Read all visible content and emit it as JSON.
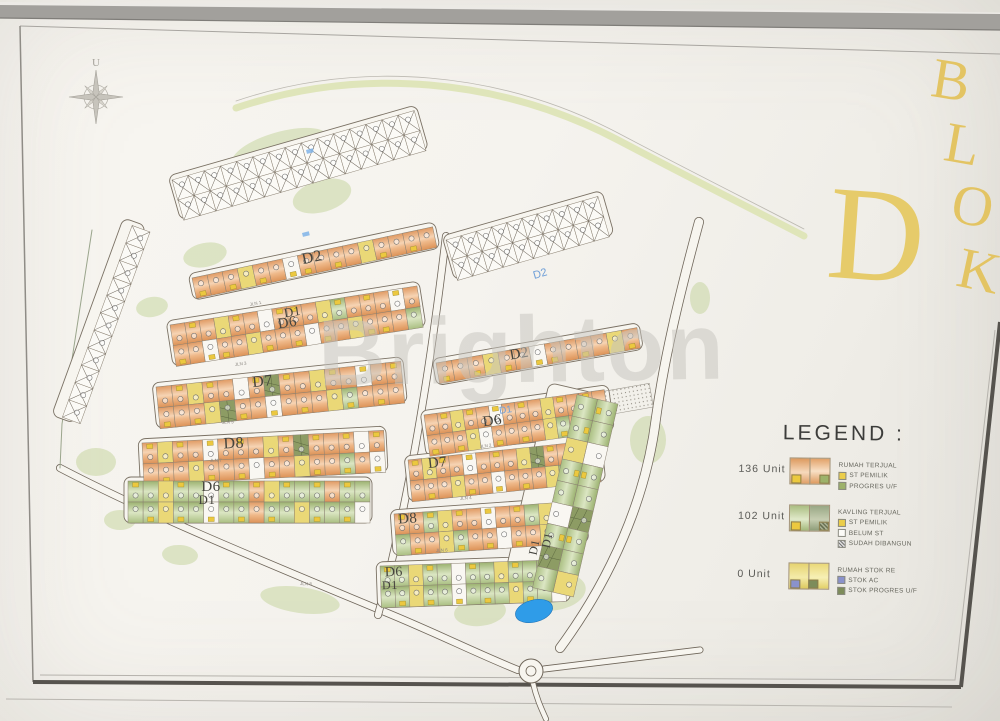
{
  "watermark": {
    "text": "Brighton"
  },
  "title": {
    "big_letter": "D",
    "vertical": [
      "B",
      "L",
      "O",
      "K"
    ],
    "color": "#e3c463"
  },
  "compass": {
    "label": "U"
  },
  "legend": {
    "title": "LEGEND :",
    "colors": {
      "yellow_mark": "#ecc93f",
      "green_mark": "#9db26a",
      "blue_mark": "#8a92cc",
      "dark_mark": "#7d8c5a"
    },
    "entries": [
      {
        "count": "136 Unit",
        "swatch": "orange",
        "lines": [
          {
            "text": "RUMAH TERJUAL"
          },
          {
            "box": "yellow",
            "text": "ST PEMILIK"
          },
          {
            "box": "green",
            "text": "PROGRES U/F"
          }
        ]
      },
      {
        "count": "102 Unit",
        "swatch": "green",
        "lines": [
          {
            "text": "KAVLING TERJUAL"
          },
          {
            "box": "yellow",
            "text": "ST PEMILIK"
          },
          {
            "box": "white",
            "text": "BELUM ST"
          },
          {
            "box": "hatch",
            "text": "SUDAH DIBANGUN"
          }
        ]
      },
      {
        "count": "0 Unit",
        "swatch": "yellow",
        "lines": [
          {
            "text": "RUMAH STOK RE"
          },
          {
            "box": "blue",
            "text": "STOK AC"
          },
          {
            "box": "dark",
            "text": "STOK PROGRES U/F"
          }
        ]
      }
    ]
  },
  "map": {
    "palette": {
      "orange": "#e8a567",
      "green": "#a9bd80",
      "yellow": "#ead877",
      "marker": "#ecc83f",
      "pond": "#2f9ce8",
      "road_line": "#6e6559",
      "paper": "#f7f5ef"
    },
    "strips": [
      {
        "x": 172,
        "y": 180,
        "a": -16,
        "len": 252,
        "w": 21,
        "m": "b",
        "lots": "xxxxxxxxxxxxxxx"
      },
      {
        "x": 178,
        "y": 200,
        "a": -16,
        "len": 252,
        "w": 21,
        "m": "b",
        "lots": "xxxxxxxxxxxxxxx"
      },
      {
        "x": 192,
        "y": 278,
        "a": -12,
        "len": 246,
        "w": 21,
        "m": "b",
        "lots": "OoOyOoWOoOoyOoOo"
      },
      {
        "x": 170,
        "y": 325,
        "a": -9,
        "len": 250,
        "w": 21,
        "m": "t",
        "lots": "oOoyOowOOoyGoOoWo"
      },
      {
        "x": 173,
        "y": 345.7,
        "a": -9,
        "len": 250,
        "w": 21,
        "m": "b",
        "lots": "OoWOoyOoOwOoyOOog"
      },
      {
        "x": 156,
        "y": 387,
        "a": -6,
        "len": 246,
        "w": 21,
        "m": "t",
        "lots": "oOyOowOdOoyOoWoO"
      },
      {
        "x": 158,
        "y": 407.9,
        "a": -6,
        "len": 246,
        "w": 21,
        "m": "b",
        "lots": "OoOydOoWoOoyGoOo"
      },
      {
        "x": 142,
        "y": 443,
        "a": -3,
        "len": 242,
        "w": 21,
        "m": "t",
        "lots": "OyOoWoOoyOdOoOwO"
      },
      {
        "x": 143,
        "y": 463.9,
        "a": -3,
        "len": 242,
        "w": 21,
        "m": "b",
        "lots": "oOoyOoOwOoyOoGoW"
      },
      {
        "x": 128,
        "y": 481,
        "a": 0,
        "len": 242,
        "w": 21,
        "m": "t",
        "lots": "GgyGgwGgOyGgGoGg"
      },
      {
        "x": 128,
        "y": 502,
        "a": 0,
        "len": 242,
        "w": 21,
        "m": "b",
        "lots": "gGyGgWgGoGgyGgGw"
      },
      {
        "x": 446,
        "y": 240,
        "a": -16,
        "len": 158,
        "w": 21,
        "m": "b",
        "lots": "xxxxxxxxxx"
      },
      {
        "x": 451.8,
        "y": 260.2,
        "a": -16,
        "len": 158,
        "w": 21,
        "m": "b",
        "lots": "xxxxxxxxxx"
      },
      {
        "x": 436,
        "y": 363,
        "a": -10,
        "len": 204,
        "w": 21,
        "m": "b",
        "lots": "OoOyOoWOoOoyO"
      },
      {
        "x": 424,
        "y": 415,
        "a": -8,
        "len": 182,
        "w": 21,
        "m": "t",
        "lots": "oOyOoWoOoyOoOo"
      },
      {
        "x": 427,
        "y": 435.6,
        "a": -8,
        "len": 182,
        "w": 21,
        "m": "b",
        "lots": "OoOywOoOoyGoWO"
      },
      {
        "x": 408,
        "y": 460,
        "a": -6,
        "len": 190,
        "w": 21,
        "m": "t",
        "lots": "OyOoWoOoydOoOo"
      },
      {
        "x": 410,
        "y": 480.9,
        "a": -6,
        "len": 190,
        "w": 21,
        "m": "b",
        "lots": "oOoyOoWoOoyGoO"
      },
      {
        "x": 394,
        "y": 514,
        "a": -4,
        "len": 188,
        "w": 21,
        "m": "t",
        "lots": "OoGyOoWoOgyOo"
      },
      {
        "x": 395.5,
        "y": 534.9,
        "a": -4,
        "len": 188,
        "w": 21,
        "m": "b",
        "lots": "gOoyGoOwOoyGo"
      },
      {
        "x": 380,
        "y": 566,
        "a": -2,
        "len": 185,
        "w": 21,
        "m": "t",
        "lots": "GgyGgwGgyGgGo"
      },
      {
        "x": 380.7,
        "y": 586.9,
        "a": -2,
        "len": 185,
        "w": 21,
        "m": "b",
        "lots": "gGyGgWgGgyGgw"
      },
      {
        "x": 618,
        "y": 404,
        "a": 103,
        "len": 198,
        "w": 21,
        "m": "b",
        "lots": "GgwGgdGgy"
      },
      {
        "x": 597.5,
        "y": 399.3,
        "a": 103,
        "len": 198,
        "w": 21,
        "m": "t",
        "lots": "gGyGgwGdg"
      },
      {
        "x": 150,
        "y": 232,
        "a": 110,
        "len": 204,
        "w": 19,
        "m": "b",
        "lots": "xxxxxxxxxxx"
      }
    ],
    "outlines": [
      {
        "x": 168,
        "y": 176,
        "len": 258,
        "h": 46,
        "a": -16
      },
      {
        "x": 188,
        "y": 274,
        "len": 252,
        "h": 27,
        "a": -12
      },
      {
        "x": 166,
        "y": 321,
        "len": 256,
        "h": 46,
        "a": -9
      },
      {
        "x": 152,
        "y": 383,
        "len": 252,
        "h": 46,
        "a": -6
      },
      {
        "x": 138,
        "y": 439,
        "len": 248,
        "h": 46,
        "a": -3
      },
      {
        "x": 124,
        "y": 477,
        "len": 248,
        "h": 46,
        "a": 0
      },
      {
        "x": 442,
        "y": 236,
        "len": 166,
        "h": 46,
        "a": -16
      },
      {
        "x": 432,
        "y": 359,
        "len": 210,
        "h": 27,
        "a": -10
      },
      {
        "x": 420,
        "y": 411,
        "len": 190,
        "h": 46,
        "a": -8
      },
      {
        "x": 404,
        "y": 456,
        "len": 198,
        "h": 46,
        "a": -6
      },
      {
        "x": 390,
        "y": 510,
        "len": 196,
        "h": 46,
        "a": -4
      },
      {
        "x": 376,
        "y": 562,
        "len": 193,
        "h": 46,
        "a": -2
      },
      {
        "x": 594,
        "y": 393,
        "len": 204,
        "h": 46,
        "a": 103
      },
      {
        "x": 146,
        "y": 226,
        "len": 210,
        "h": 24,
        "a": 110
      }
    ],
    "roads": [
      {
        "kind": "belt",
        "d": "M236,108 C360,66 500,78 618,140 C690,178 754,210 804,236",
        "w": 7,
        "color": "#dde3b4"
      },
      {
        "kind": "line",
        "d": "M236,101 C360,59 500,71 618,133 C690,171 754,203 804,229",
        "w": 0.8,
        "color": "#bcb9b1"
      },
      {
        "kind": "road",
        "d": "M699,222 C678,300 664,360 656,418 C646,500 610,580 560,648",
        "w": 10
      },
      {
        "kind": "road",
        "d": "M60,468 C150,515 260,560 380,610 C430,630 480,655 518,670",
        "w": 8
      },
      {
        "kind": "road",
        "d": "M544,669 C600,662 650,656 700,650",
        "w": 7
      },
      {
        "kind": "road",
        "d": "M446,236 C436,320 420,440 392,560 C386,585 382,600 378,615",
        "w": 8
      },
      {
        "kind": "road",
        "d": "M533,683 C537,700 542,710 546,719",
        "w": 6
      },
      {
        "kind": "line",
        "d": "M92,230 L62,424 L60,468",
        "w": 1,
        "color": "#9aa58c"
      }
    ],
    "green_patches": [
      {
        "x": 280,
        "y": 150,
        "rx": 50,
        "ry": 18,
        "a": -16
      },
      {
        "x": 322,
        "y": 196,
        "rx": 30,
        "ry": 16,
        "a": -16
      },
      {
        "x": 205,
        "y": 255,
        "rx": 22,
        "ry": 12,
        "a": -12
      },
      {
        "x": 152,
        "y": 307,
        "rx": 16,
        "ry": 10,
        "a": -9
      },
      {
        "x": 96,
        "y": 462,
        "rx": 20,
        "ry": 14,
        "a": 0
      },
      {
        "x": 120,
        "y": 520,
        "rx": 16,
        "ry": 10,
        "a": 0
      },
      {
        "x": 180,
        "y": 555,
        "rx": 18,
        "ry": 10,
        "a": 4
      },
      {
        "x": 300,
        "y": 600,
        "rx": 40,
        "ry": 13,
        "a": 8
      },
      {
        "x": 480,
        "y": 612,
        "rx": 26,
        "ry": 14,
        "a": -6
      },
      {
        "x": 556,
        "y": 592,
        "rx": 30,
        "ry": 18,
        "a": -10
      },
      {
        "x": 648,
        "y": 440,
        "rx": 18,
        "ry": 24,
        "a": 0
      },
      {
        "x": 700,
        "y": 298,
        "rx": 10,
        "ry": 16,
        "a": 0
      }
    ],
    "block_labels": [
      {
        "t": "D2",
        "x": 313,
        "y": 262,
        "a": -12,
        "s": 16
      },
      {
        "t": "D1",
        "x": 293,
        "y": 316,
        "a": -9,
        "s": 13
      },
      {
        "t": "D6",
        "x": 288,
        "y": 327,
        "a": -9,
        "s": 15
      },
      {
        "t": "D7",
        "x": 263,
        "y": 386,
        "a": -6,
        "s": 16
      },
      {
        "t": "D8",
        "x": 234,
        "y": 448,
        "a": -3,
        "s": 16
      },
      {
        "t": "D6",
        "x": 211,
        "y": 491,
        "a": 0,
        "s": 15
      },
      {
        "t": "D1",
        "x": 207,
        "y": 504,
        "a": 0,
        "s": 13
      },
      {
        "t": "D2",
        "x": 520,
        "y": 358,
        "a": -10,
        "s": 15
      },
      {
        "t": "D6",
        "x": 493,
        "y": 425,
        "a": -8,
        "s": 15
      },
      {
        "t": "D7",
        "x": 438,
        "y": 467,
        "a": -6,
        "s": 15
      },
      {
        "t": "D8",
        "x": 408,
        "y": 523,
        "a": -4,
        "s": 15
      },
      {
        "t": "D6",
        "x": 394,
        "y": 576,
        "a": -2,
        "s": 14
      },
      {
        "t": "D1",
        "x": 390,
        "y": 589,
        "a": -2,
        "s": 12
      },
      {
        "t": "D1",
        "x": 538,
        "y": 548,
        "a": -78,
        "s": 12
      },
      {
        "t": "D1",
        "x": 551,
        "y": 541,
        "a": -78,
        "s": 12
      }
    ],
    "road_labels": [
      {
        "t": "D2",
        "x": 541,
        "y": 277,
        "a": -16,
        "c": "#6f9fd8",
        "s": 11
      },
      {
        "t": "D1",
        "x": 506,
        "y": 413,
        "a": -8,
        "c": "#6f9fd8",
        "s": 10
      }
    ],
    "street_labels": [
      {
        "t": "JLN 1",
        "x": 250,
        "y": 306,
        "a": -11
      },
      {
        "t": "JLN 3",
        "x": 235,
        "y": 366,
        "a": -7
      },
      {
        "t": "JLN 5",
        "x": 222,
        "y": 424,
        "a": -4
      },
      {
        "t": "JLN 7",
        "x": 210,
        "y": 462,
        "a": -1
      },
      {
        "t": "JLN 2",
        "x": 480,
        "y": 448,
        "a": -7
      },
      {
        "t": "JLN 4",
        "x": 460,
        "y": 500,
        "a": -5
      },
      {
        "t": "JLN 6",
        "x": 436,
        "y": 552,
        "a": -3
      },
      {
        "t": "JLN 8",
        "x": 300,
        "y": 585,
        "a": 2
      }
    ],
    "blue_ticks": [
      {
        "x": 306,
        "y": 150
      },
      {
        "x": 302,
        "y": 233
      }
    ],
    "pond": {
      "x": 534,
      "y": 611,
      "rx": 19,
      "ry": 11,
      "a": -15
    },
    "stipple": {
      "x": 600,
      "y": 392,
      "w": 50,
      "h": 24,
      "a": -10
    },
    "roundabout": {
      "x": 531,
      "y": 671,
      "r1": 12,
      "r2": 5
    }
  }
}
